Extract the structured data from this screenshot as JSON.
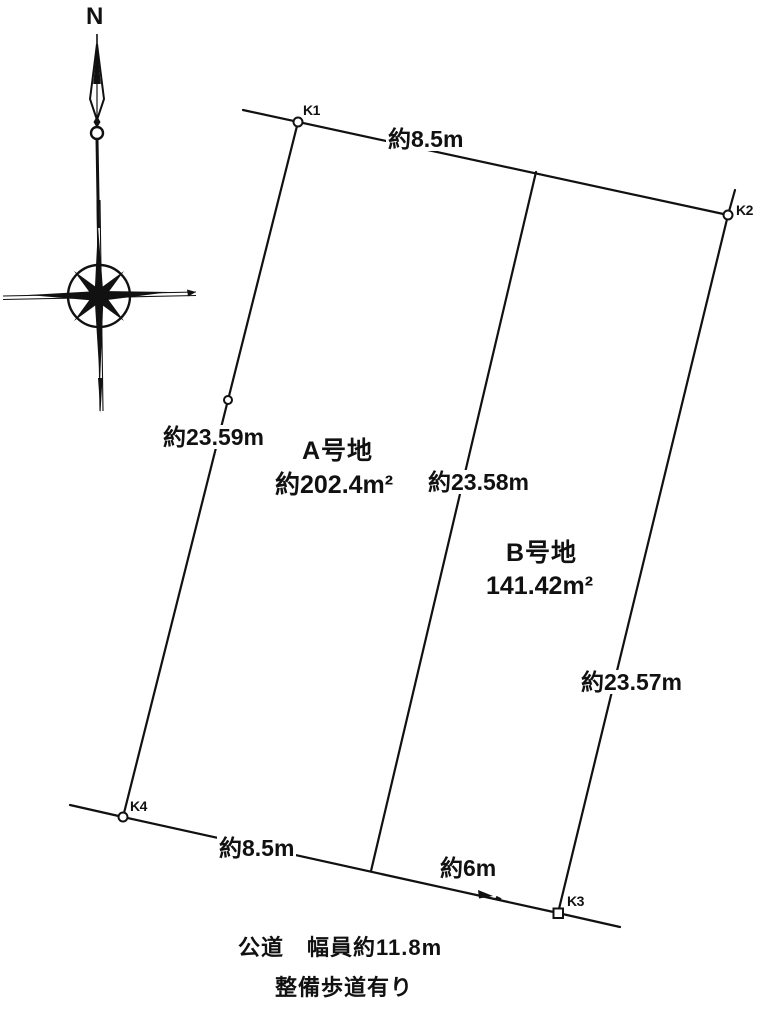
{
  "compass": {
    "north_label": "N"
  },
  "points": {
    "k1": "K1",
    "k2": "K2",
    "k3": "K3",
    "k4": "K4"
  },
  "parcels": {
    "a": {
      "name": "A号地",
      "area": "約202.4m²"
    },
    "b": {
      "name": "B号地",
      "area": "141.42m²"
    }
  },
  "dimensions": {
    "top": "約8.5m",
    "left": "約23.59m",
    "center": "約23.58m",
    "right": "約23.57m",
    "bottom_left": "約8.5m",
    "bottom_center": "約6m"
  },
  "road": {
    "type_and_width": "公道　幅員約11.8m",
    "sidewalk_note": "整備歩道有り"
  },
  "colors": {
    "line": "#111111",
    "background": "#ffffff",
    "text": "#111111"
  }
}
